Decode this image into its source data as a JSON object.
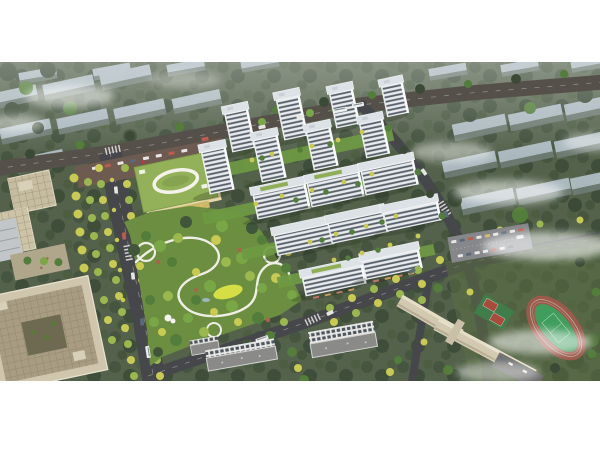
{
  "scene": {
    "alt": "Aerial architectural rendering of a residential development: white high-rise towers around landscaped courtyards, a large central park with winding paths, a green-roofed kindergarten, tree-lined boulevards, a school campus with running track and basketball courts, beige office blocks, and faded context buildings in mist",
    "frame": {
      "background": "#ffffff",
      "photo_top_px": 62,
      "photo_height_px": 319,
      "width_px": 600,
      "height_px": 450
    }
  },
  "palette": {
    "land": "#54624c",
    "road": "#46474a",
    "road_top": "#56504b",
    "park_green": "#6c8e41",
    "lawn_yellow": "#d6de45",
    "path_white": "#efeee6",
    "tower_white": "#eceef0",
    "window_dark": "#57616a",
    "kindergarten_roof": "#93b158",
    "beige_building": "#cfc6ad",
    "beige_roof": "#a89d83",
    "field_green": "#3f9e5e",
    "track_red": "#9b5a4b",
    "court_red": "#b0483a",
    "context_roof": "#b5c3cc",
    "tree_yellow": "#c9ca52",
    "mist": "#ffffff"
  }
}
